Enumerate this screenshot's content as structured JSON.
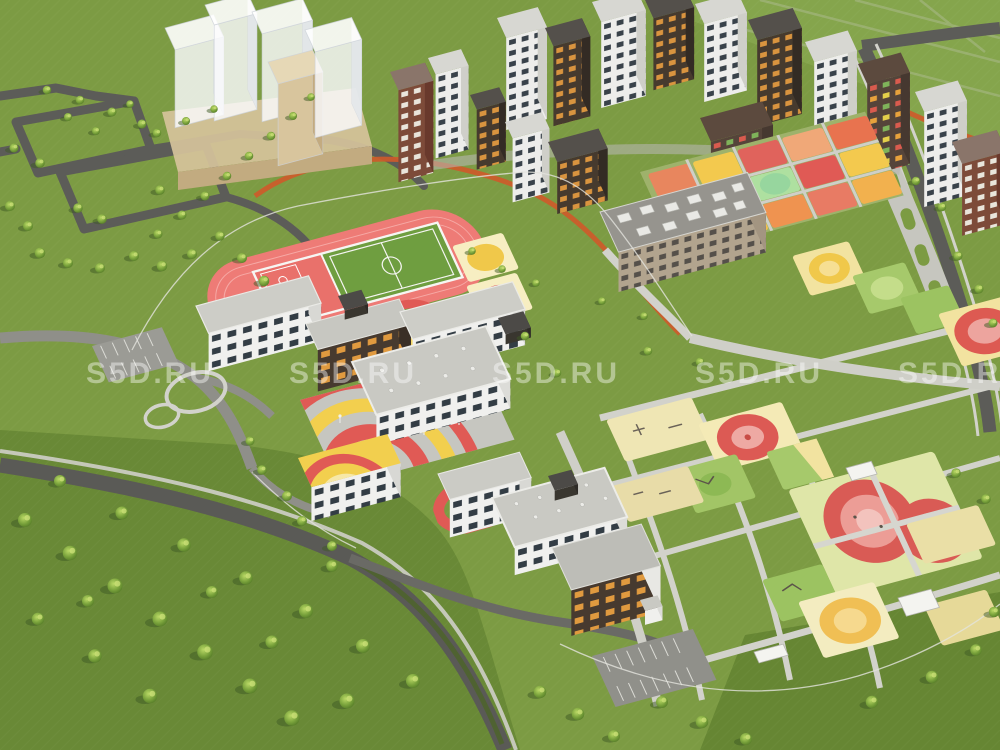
{
  "watermark": {
    "text": "S5D.RU",
    "color": "rgba(255,255,255,0.42)"
  },
  "palette": {
    "grass": "#7c9b43",
    "park_grass": "#6a8a34",
    "road_dark": "#5c5c58",
    "road_light": "#9b9b95",
    "path_light": "#cfcfc8",
    "track_red": "#ee7b76",
    "court_red": "#e9716b",
    "field_green": "#6f9e40",
    "roof_gray": "#c9c9c3",
    "roof_dark": "#4c4a47",
    "facade_white": "#efefec",
    "facade_brown": "#473a2f",
    "facade_brick": "#7d4b39",
    "facade_beige": "#b2a48e",
    "ghost_white": "rgba(250,250,252,0.82)",
    "ghost_beige": "#d8c59d",
    "accent_red": "#dd5a52",
    "accent_pink": "#eda49e",
    "accent_yellow": "#f2cf4e",
    "accent_orange": "#ef9350",
    "accent_pale": "#f4ecc0",
    "accent_green": "#a6c96b",
    "jog_orange": "#cf5a2a",
    "tree_light": "#a5c94f",
    "tree_dark": "#4c6b2a"
  }
}
